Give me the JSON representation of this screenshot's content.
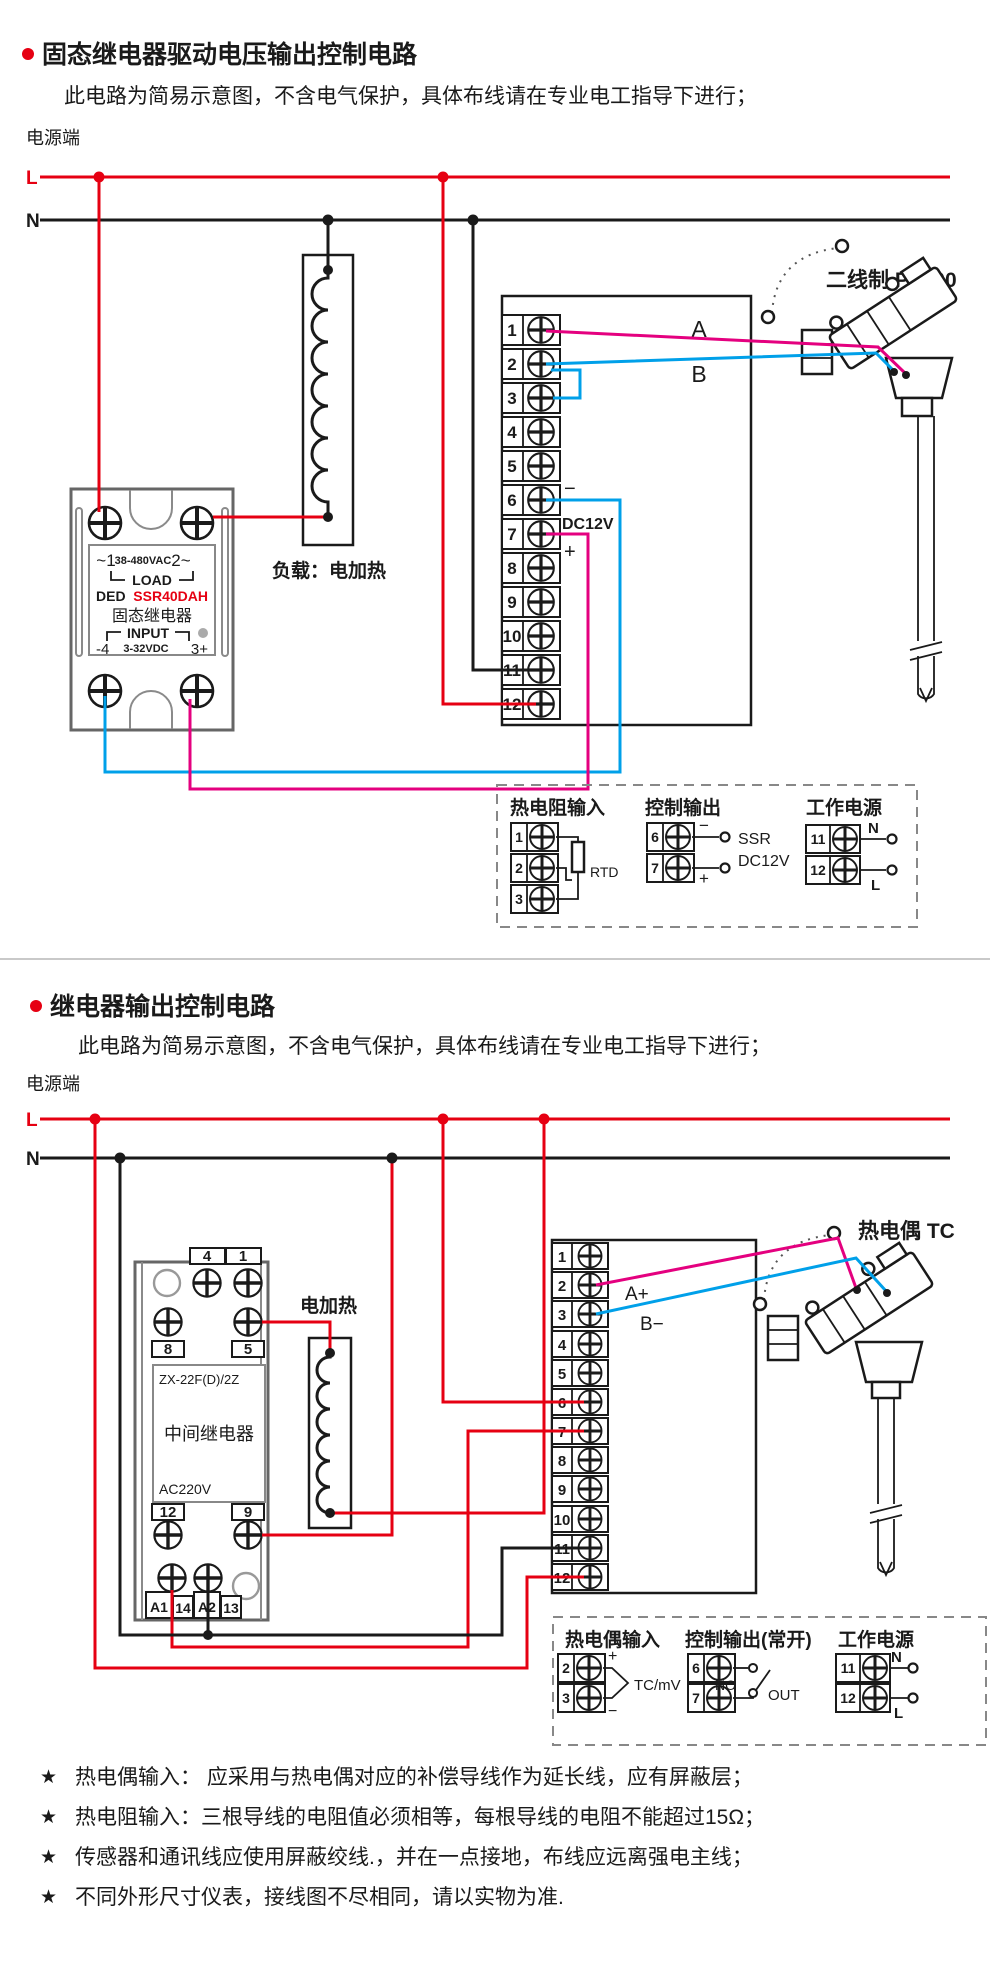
{
  "colors": {
    "accent_red": "#e60012",
    "wire_magenta": "#e4007f",
    "wire_blue": "#00a0e9",
    "ink": "#1a1a1a"
  },
  "s1": {
    "title": "固态继电器驱动电压输出控制电路",
    "subtitle": "此电路为简易示意图，不含电气保护，具体布线请在专业电工指导下进行；",
    "power_end": "电源端",
    "l": "L",
    "n": "N",
    "terminals": [
      "1",
      "2",
      "3",
      "4",
      "5",
      "6",
      "7",
      "8",
      "9",
      "10",
      "11",
      "12"
    ],
    "wire_a": "A",
    "wire_b": "B",
    "minus": "−",
    "plus": "+",
    "dc12v": "DC12V",
    "load_label": "负载：电加热",
    "sensor_label": "二线制 PT100",
    "ssr": {
      "t1": "~1",
      "vac": "38-480VAC",
      "t2": "2~",
      "load": "LOAD",
      "brand": "DED",
      "model": "SSR40DAH",
      "name": "固态继电器",
      "input": "INPUT",
      "t4": "-4",
      "vdc": "3-32VDC",
      "t3": "3+"
    },
    "info": {
      "rtd_title": "热电阻输入",
      "rtd": "RTD",
      "t": [
        "1",
        "2",
        "3"
      ],
      "out_title": "控制输出",
      "out_t": [
        "6",
        "7"
      ],
      "minus": "−",
      "plus": "+",
      "ssr": "SSR",
      "dc12v": "DC12V",
      "pwr_title": "工作电源",
      "pwr_t": [
        "11",
        "12"
      ],
      "n": "N",
      "l": "L"
    }
  },
  "s2": {
    "title": "继电器输出控制电路",
    "subtitle": "此电路为简易示意图，不含电气保护，具体布线请在专业电工指导下进行；",
    "power_end": "电源端",
    "l": "L",
    "n": "N",
    "terminals": [
      "1",
      "2",
      "3",
      "4",
      "5",
      "6",
      "7",
      "8",
      "9",
      "10",
      "11",
      "12"
    ],
    "wire_a": "A+",
    "wire_b": "B−",
    "heater_label": "电加热",
    "sensor_label": "热电偶 TC",
    "relay": {
      "c4": "4",
      "c1": "1",
      "c8": "8",
      "c5": "5",
      "model": "ZX-22F(D)/2Z",
      "name": "中间继电器",
      "volt": "AC220V",
      "c12": "12",
      "c9": "9",
      "a1": "A1",
      "n14": "14",
      "a2": "A2",
      "n13": "13"
    },
    "info": {
      "tc_title": "热电偶输入",
      "t": [
        "2",
        "3"
      ],
      "plus": "+",
      "minus": "−",
      "tcmv": "TC/mV",
      "out_title": "控制输出(常开)",
      "out_t": [
        "6",
        "7"
      ],
      "no": "NO",
      "out": "OUT",
      "pwr_title": "工作电源",
      "pwr_t": [
        "11",
        "12"
      ],
      "n": "N",
      "l": "L"
    }
  },
  "notes": {
    "bullet": "★",
    "items": [
      "热电偶输入： 应采用与热电偶对应的补偿导线作为延长线，应有屏蔽层；",
      "热电阻输入：三根导线的电阻值必须相等，每根导线的电阻不能超过15Ω；",
      "传感器和通讯线应使用屏蔽绞线.，并在一点接地，布线应远离强电主线；",
      "不同外形尺寸仪表，接线图不尽相同，请以实物为准."
    ]
  }
}
